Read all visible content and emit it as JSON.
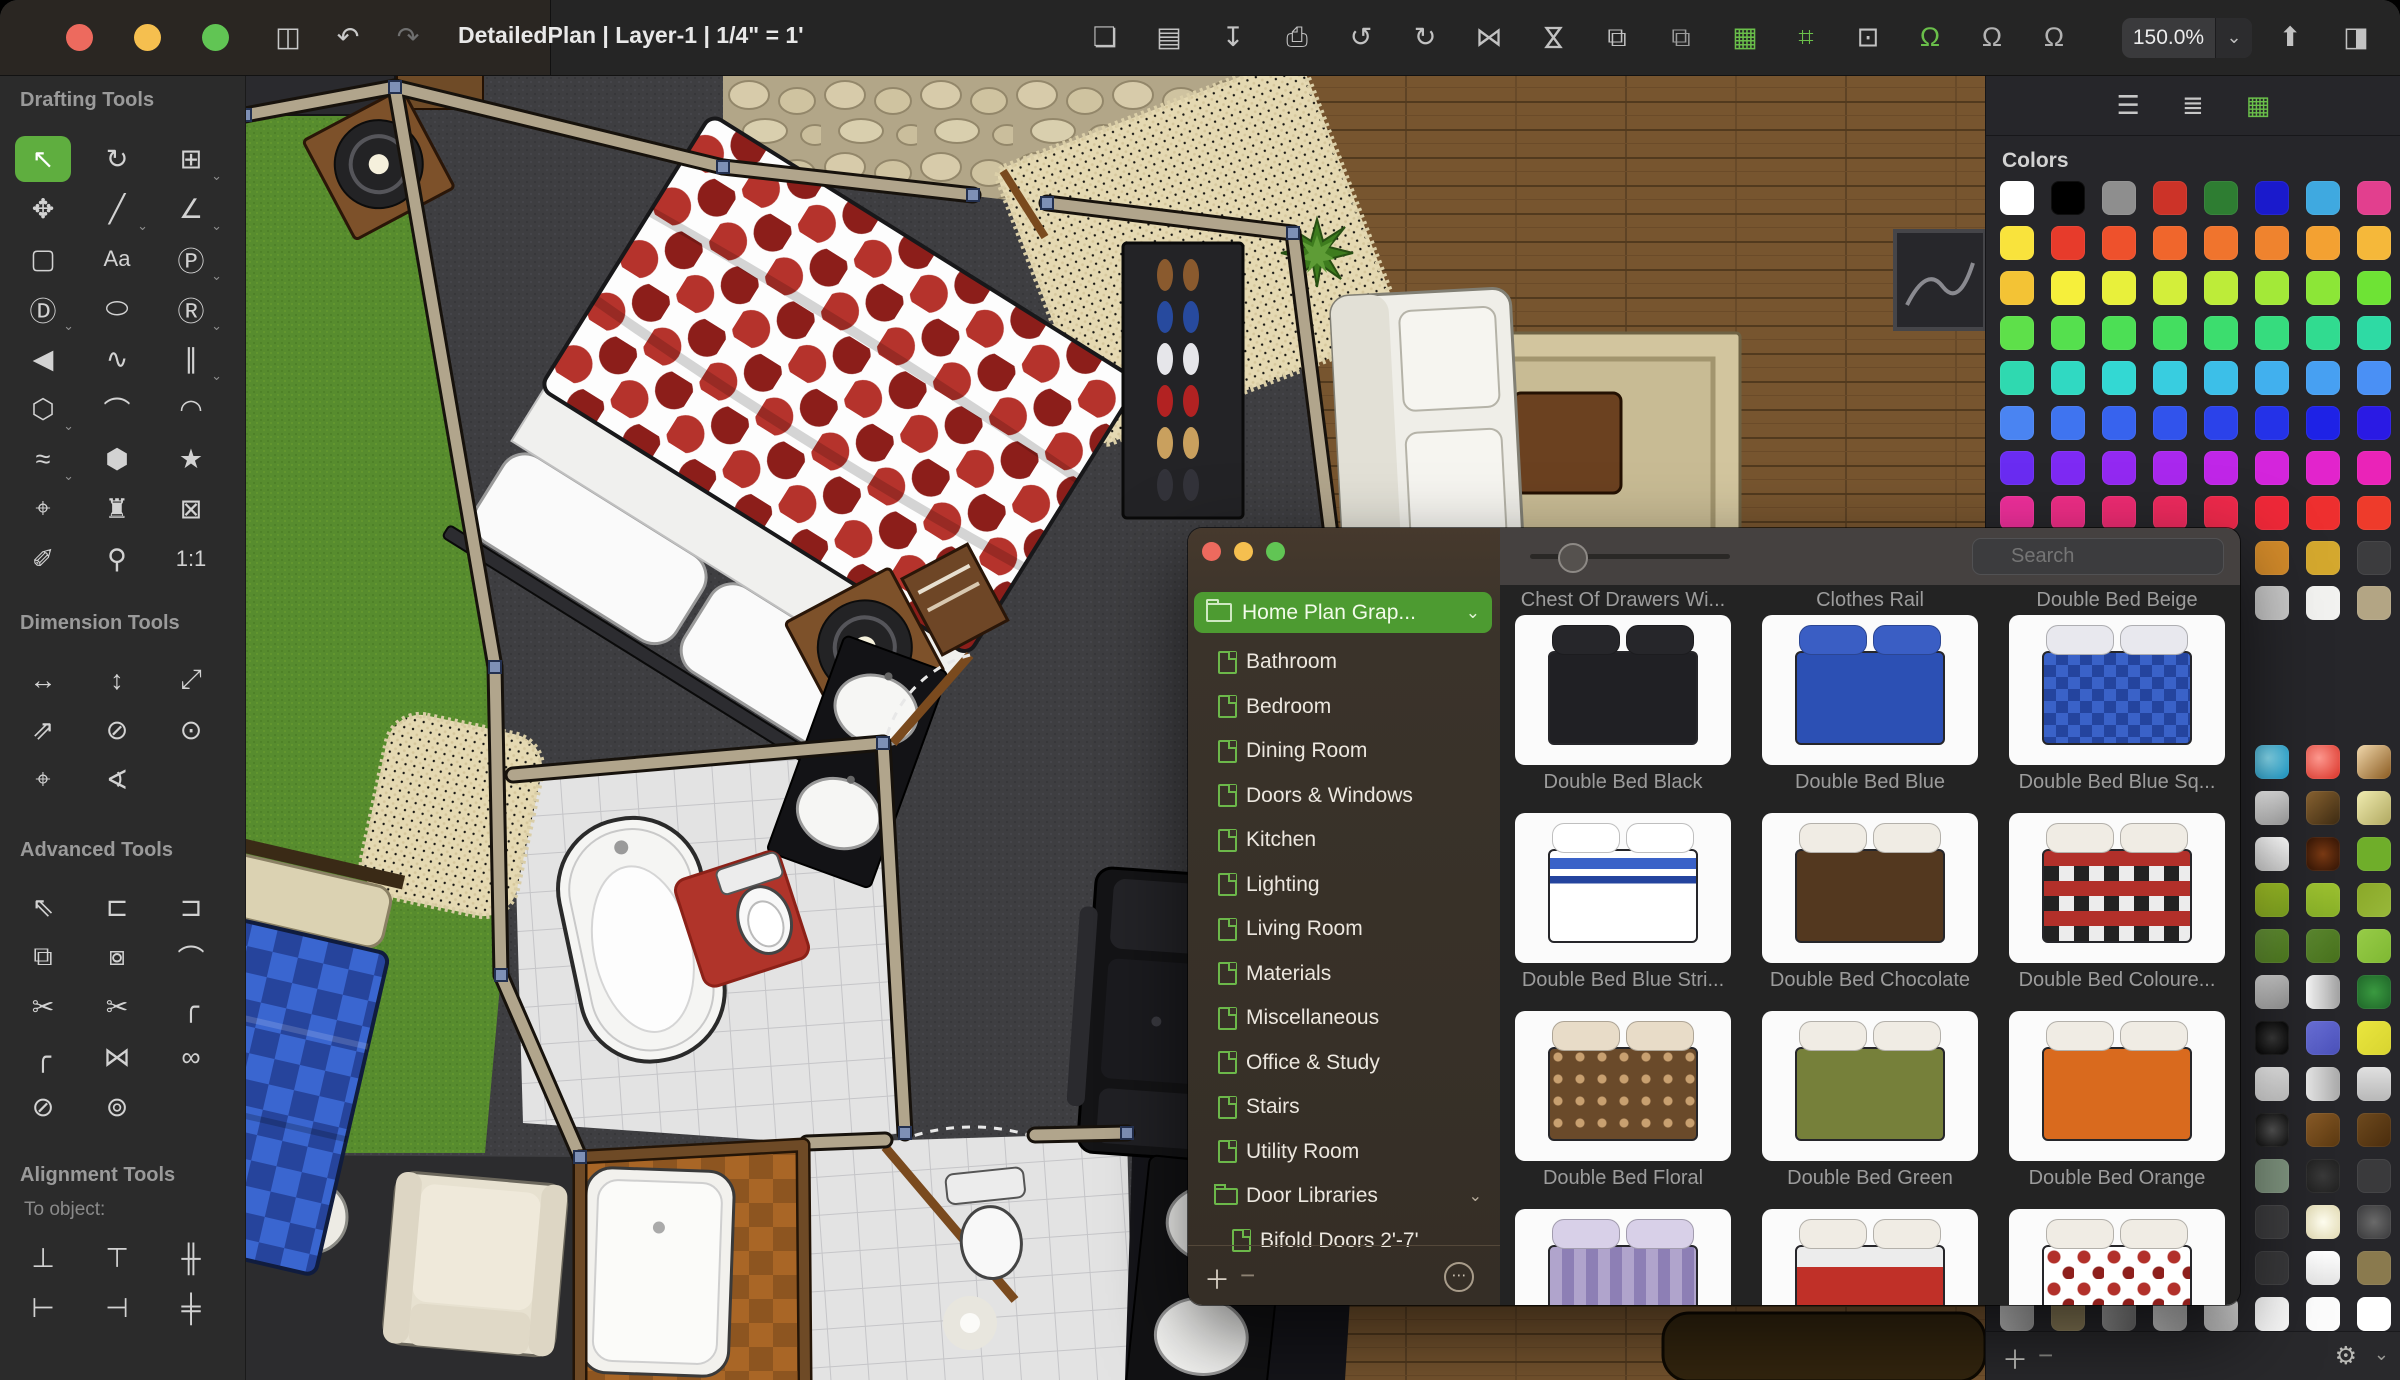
{
  "window": {
    "title": "DetailedPlan | Layer-1 | 1/4\" = 1'",
    "zoom_level": "150.0%",
    "traffic_lights": [
      "#ed6a5e",
      "#f5bf4f",
      "#61c554"
    ]
  },
  "toolbar": {
    "left_icons": [
      {
        "name": "sidebar-toggle",
        "glyph": "◫",
        "color": "#c8c8c8"
      },
      {
        "name": "undo",
        "glyph": "↶",
        "color": "#c8c8c8"
      },
      {
        "name": "redo",
        "glyph": "↷",
        "color": "#6f6f6f"
      }
    ],
    "main_icons": [
      {
        "name": "new-document",
        "glyph": "❏",
        "color": "#c2c2c2"
      },
      {
        "name": "open-folder",
        "glyph": "▤",
        "color": "#c2c2c2"
      },
      {
        "name": "import",
        "glyph": "↧",
        "color": "#c2c2c2"
      },
      {
        "name": "print",
        "glyph": "⎙",
        "color": "#c2c2c2"
      },
      {
        "name": "rotate-left",
        "glyph": "↺",
        "color": "#c2c2c2"
      },
      {
        "name": "rotate-right",
        "glyph": "↻",
        "color": "#c2c2c2"
      },
      {
        "name": "flip-horizontal",
        "glyph": "⋈",
        "color": "#c2c2c2"
      },
      {
        "name": "flip-vertical",
        "glyph": "⋈",
        "color": "#c2c2c2",
        "rot": true
      },
      {
        "name": "copy-style",
        "glyph": "⧉",
        "color": "#c2c2c2"
      },
      {
        "name": "duplicate",
        "glyph": "⧉",
        "color": "#9c9c9c"
      },
      {
        "name": "grid-view",
        "glyph": "▦",
        "color": "#6abf4a"
      }
    ],
    "snap_icons": [
      {
        "name": "snap-to-guides",
        "glyph": "⌗",
        "color": "#6abf4a"
      },
      {
        "name": "frame-tool",
        "glyph": "⊡",
        "color": "#c2c2c2"
      },
      {
        "name": "snap-to-object",
        "glyph": "Ω",
        "color": "#6abf4a"
      },
      {
        "name": "snap-to-grid",
        "glyph": "Ω",
        "color": "#b2b2b2"
      },
      {
        "name": "snap-to-edge",
        "glyph": "Ω",
        "color": "#b2b2b2"
      }
    ],
    "right_icons": [
      {
        "name": "share",
        "glyph": "⬆",
        "color": "#c2c2c2"
      },
      {
        "name": "right-panel-toggle",
        "glyph": "◨",
        "color": "#c2c2c2"
      }
    ],
    "zoom_chevron": "⌄"
  },
  "sidebar": {
    "sections": [
      {
        "title": "Drafting Tools",
        "tools": [
          {
            "name": "select-tool",
            "glyph": "↖",
            "active": true
          },
          {
            "name": "rotate-tool",
            "glyph": "↻"
          },
          {
            "name": "crop-tool",
            "glyph": "⊞",
            "menu": true
          },
          {
            "name": "pan-tool",
            "glyph": "✥"
          },
          {
            "name": "line-tool",
            "glyph": "╱",
            "menu": true
          },
          {
            "name": "angle-line-tool",
            "glyph": "∠",
            "menu": true
          },
          {
            "name": "rectangle-tool",
            "glyph": "▢"
          },
          {
            "name": "text-tool",
            "glyph": "Aa",
            "small": true
          },
          {
            "name": "parametric-shape-tool",
            "glyph": "Ⓟ",
            "menu": true
          },
          {
            "name": "dimension-shape-tool",
            "glyph": "Ⓓ",
            "menu": true
          },
          {
            "name": "ellipse-tool",
            "glyph": "⬭"
          },
          {
            "name": "rounded-rect-tool",
            "glyph": "Ⓡ",
            "menu": true
          },
          {
            "name": "arrow-shape-tool",
            "glyph": "◀"
          },
          {
            "name": "zigzag-tool",
            "glyph": "∿"
          },
          {
            "name": "parallel-line-tool",
            "glyph": "∥",
            "menu": true
          },
          {
            "name": "polygon-tool",
            "glyph": "⬡",
            "menu": true
          },
          {
            "name": "bezier-tool",
            "glyph": "⌒"
          },
          {
            "name": "arc-tool",
            "glyph": "◠"
          },
          {
            "name": "freehand-tool",
            "glyph": "≈",
            "menu": true
          },
          {
            "name": "blob-tool",
            "glyph": "⬢"
          },
          {
            "name": "star-tool",
            "glyph": "★"
          },
          {
            "name": "center-mark-tool",
            "glyph": "⌖"
          },
          {
            "name": "stamp-tool",
            "glyph": "♜"
          },
          {
            "name": "delete-box-tool",
            "glyph": "⊠"
          },
          {
            "name": "eyedropper-tool",
            "glyph": "✐"
          },
          {
            "name": "zoom-tool",
            "glyph": "⚲"
          },
          {
            "name": "actual-size-tool",
            "glyph": "1:1",
            "small": true
          }
        ]
      },
      {
        "title": "Dimension Tools",
        "tools": [
          {
            "name": "horizontal-dimension-tool",
            "glyph": "↔"
          },
          {
            "name": "vertical-dimension-tool",
            "glyph": "↕"
          },
          {
            "name": "diagonal-dimension-tool",
            "glyph": "⤢"
          },
          {
            "name": "angled-dimension-tool",
            "glyph": "⇗"
          },
          {
            "name": "diameter-dimension-tool",
            "glyph": "⊘"
          },
          {
            "name": "radius-dimension-tool",
            "glyph": "⊙"
          },
          {
            "name": "center-dimension-tool",
            "glyph": "⌖"
          },
          {
            "name": "angle-dimension-tool",
            "glyph": "∢"
          }
        ]
      },
      {
        "title": "Advanced Tools",
        "tools": [
          {
            "name": "advanced-select-tool",
            "glyph": "⇖"
          },
          {
            "name": "push-left-tool",
            "glyph": "⊏"
          },
          {
            "name": "push-right-tool",
            "glyph": "⊐"
          },
          {
            "name": "combine-shapes-tool",
            "glyph": "⧉"
          },
          {
            "name": "subtract-shapes-tool",
            "glyph": "⧇"
          },
          {
            "name": "edit-points-tool",
            "glyph": "⌒"
          },
          {
            "name": "cut-tool",
            "glyph": "✂"
          },
          {
            "name": "cut-multiple-tool",
            "glyph": "✂"
          },
          {
            "name": "fillet-corner-tool",
            "glyph": "╭"
          },
          {
            "name": "chamfer-corner-tool",
            "glyph": "╭"
          },
          {
            "name": "mirror-tool",
            "glyph": "⋈"
          },
          {
            "name": "link-objects-tool",
            "glyph": "∞"
          },
          {
            "name": "unlink-objects-tool",
            "glyph": "⊘"
          },
          {
            "name": "unlink-all-tool",
            "glyph": "⊚"
          }
        ]
      },
      {
        "title": "Alignment Tools",
        "subtitle": "To object:",
        "tools": [
          {
            "name": "align-bottom-tool",
            "glyph": "⊥"
          },
          {
            "name": "align-top-tool",
            "glyph": "⊤"
          },
          {
            "name": "distribute-vertical-tool",
            "glyph": "╫"
          },
          {
            "name": "align-left-tool",
            "glyph": "⊢"
          },
          {
            "name": "align-right-tool",
            "glyph": "⊣"
          },
          {
            "name": "distribute-horizontal-tool",
            "glyph": "╪"
          }
        ]
      }
    ]
  },
  "library": {
    "collection": "Home Plan Grap...",
    "collection_chevron": "⌄",
    "categories": [
      "Bathroom",
      "Bedroom",
      "Dining Room",
      "Doors & Windows",
      "Kitchen",
      "Lighting",
      "Living Room",
      "Materials",
      "Miscellaneous",
      "Office & Study",
      "Stairs",
      "Utility Room"
    ],
    "folder": "Door Libraries",
    "folder_chevron": "⌄",
    "folder_child": "Bifold Doors 2'-7'",
    "search_placeholder": "Search",
    "footer": {
      "add": "＋",
      "remove": "−",
      "more": "⋯"
    },
    "top_captions": [
      "Chest Of Drawers Wi...",
      "Clothes Rail",
      "Double Bed Beige"
    ],
    "rows": [
      [
        {
          "label": "Double Bed Black",
          "style": "black"
        },
        {
          "label": "Double Bed Blue",
          "style": "blue"
        },
        {
          "label": "Double Bed Blue Sq...",
          "style": "bluesq"
        }
      ],
      [
        {
          "label": "Double Bed Blue Stri...",
          "style": "bluestri"
        },
        {
          "label": "Double Bed Chocolate",
          "style": "chocolate"
        },
        {
          "label": "Double Bed Coloure...",
          "style": "coloured"
        }
      ],
      [
        {
          "label": "Double Bed Floral",
          "style": "floral"
        },
        {
          "label": "Double Bed Green",
          "style": "green"
        },
        {
          "label": "Double Bed Orange",
          "style": "orange"
        }
      ],
      [
        {
          "label": "",
          "style": "purple"
        },
        {
          "label": "",
          "style": "redwhite"
        },
        {
          "label": "",
          "style": "polka"
        }
      ]
    ]
  },
  "colors_panel": {
    "title": "Colors",
    "header_icons": [
      {
        "name": "adjust-sliders",
        "glyph": "☰",
        "color": "#c7c7c7"
      },
      {
        "name": "layers",
        "glyph": "≣",
        "color": "#c7c7c7"
      },
      {
        "name": "swatch-grid",
        "glyph": "▦",
        "color": "#6abf4a"
      }
    ],
    "solid_rows": [
      [
        "#ffffff",
        "#000000",
        "#8e8e8e",
        "#cc3328",
        "#2e7d32",
        "#1a1acc",
        "#3fa9e0",
        "#e23f8e"
      ],
      [
        "#f9e33c",
        "#e73b2b",
        "#ee512c",
        "#f0662c",
        "#f0742d",
        "#ef832e",
        "#f3a132",
        "#f5b83a"
      ],
      [
        "#f3c335",
        "#f6ef3b",
        "#e8f03b",
        "#d3ee3a",
        "#bdec39",
        "#a3e938",
        "#8ce637",
        "#6ee335"
      ],
      [
        "#5ee04a",
        "#55e04e",
        "#4cdf55",
        "#44de60",
        "#3cdd6e",
        "#36dc7e",
        "#31db90",
        "#2edaa4"
      ],
      [
        "#2fd9b0",
        "#30d9c2",
        "#33d8d3",
        "#38cde0",
        "#3cbfe8",
        "#41b0ee",
        "#47a0f2",
        "#4a90f5"
      ],
      [
        "#4a84f2",
        "#3f74f0",
        "#3763ee",
        "#3153ec",
        "#2b42ea",
        "#2432e8",
        "#1e22e6",
        "#2a1ae4"
      ],
      [
        "#6a2cf2",
        "#7e2af4",
        "#9329f2",
        "#a928ee",
        "#c026e8",
        "#d425dc",
        "#e224cc",
        "#ea23b8"
      ],
      [
        "#ee2f9a",
        "#ee2d86",
        "#ee2b72",
        "#ee2a5e",
        "#ee294b",
        "#ee2838",
        "#ee2f2f",
        "#ee3b2b"
      ],
      [
        "#8a6a25",
        "#a07828",
        "#b8862b",
        "#c8942d",
        "#d2a02f",
        "#d28a2a",
        "#d4a82e",
        "#3c3c3e"
      ],
      [
        "#6a6a6c",
        "#7c7c7e",
        "#8e8e90",
        "#a8a8aa",
        "#bcbcbe",
        "#c9c9c9",
        "#f2f2f0",
        "#b3a584"
      ]
    ],
    "material_rows": [
      [
        "#4a4a4c",
        "#54544e",
        "#5e5a50",
        "#68604e",
        "#72664c",
        "radial-gradient(circle at 38% 38%, #8ae0f5, #1898c8)",
        "radial-gradient(circle at 38% 38%, #ff9a90, #d93025)",
        "linear-gradient(135deg, #f0d8ac, #8a5a20)"
      ],
      [
        "#4c4c4e",
        "#565650",
        "#605c52",
        "#6a6250",
        "#74684e",
        "linear-gradient(135deg, #ffffff, #9a9a9a)",
        "linear-gradient(135deg, #8a6432, #3c2a12)",
        "linear-gradient(135deg, #f0ecb0, #b0a860)"
      ],
      [
        "#4e4e50",
        "#585852",
        "#625e54",
        "#6c6452",
        "#766a50",
        "linear-gradient(180deg, #ffffff, #d0d0d0)",
        "radial-gradient(circle, #7a3a14, #2e1204)",
        "#6fae2a"
      ],
      [
        "#505052",
        "#5a5a54",
        "#646056",
        "#6e6654",
        "#786c52",
        "linear-gradient(135deg, #a8c828, #7ba020)",
        "linear-gradient(180deg, #9cc030, #88b028)",
        "linear-gradient(135deg, #8aa828, #98b83a)"
      ],
      [
        "#525254",
        "#5c5c56",
        "#666258",
        "#706856",
        "#7a6e54",
        "linear-gradient(135deg, #68963a, #4e7a1e)",
        "linear-gradient(135deg, #5c8830, #47701c)",
        "linear-gradient(135deg, #97cc48, #7fb832)"
      ],
      [
        "#545456",
        "#5e5e58",
        "#68645a",
        "#726a58",
        "#7c7056",
        "linear-gradient(135deg, #e0e0e0, #909090)",
        "linear-gradient(90deg, #f8f8f8, #a0a0a0)",
        "radial-gradient(circle, #3a9a40, #1e6428)"
      ],
      [
        "#565658",
        "#60605a",
        "#6a665c",
        "#746c5a",
        "#7e7258",
        "radial-gradient(circle, #3a3a3a, #000000)",
        "linear-gradient(135deg, #6a70d8, #4a50b8)",
        "linear-gradient(135deg, #eae63e, #d8d430)"
      ],
      [
        "#58585a",
        "#62625c",
        "#6c685e",
        "#766e5c",
        "#80745a",
        "linear-gradient(135deg, #f8f8f8, #c0c0c0)",
        "linear-gradient(90deg, #e8e8e8, #a8a8a8)",
        "linear-gradient(180deg, #e0e0e0, #b8b8b8)"
      ],
      [
        "#5a5a5c",
        "#64645e",
        "#6e6a60",
        "#78705e",
        "#82765c",
        "radial-gradient(circle, #555555, #0a0a0a)",
        "linear-gradient(135deg, #8a5c28, #5a3810)",
        "linear-gradient(135deg, #6e4a1e, #4a2c0c)"
      ],
      [
        "#5c5c5e",
        "#666660",
        "#706c62",
        "#7a7260",
        "#84785e",
        "#7e937e",
        "radial-gradient(circle, #3a3a3a, #1e1e1e)",
        "#3a3a3c"
      ],
      [
        "#5e5e60",
        "#686862",
        "#726e64",
        "#7c7462",
        "#867a60",
        "#3c3c3e",
        "radial-gradient(circle, #fffef0, #e0d8b0)",
        "radial-gradient(circle, #6a6a6a, #38383a)"
      ],
      [
        "#606062",
        "#6a6a64",
        "#747066",
        "#7e7664",
        "#887c62",
        "#38383a",
        "linear-gradient(180deg, #ffffff, #e4e4e4)",
        "#8a7a4e"
      ],
      [
        "linear-gradient(135deg, #e8e8e8, #9a9a9a)",
        "#8a7c58",
        "linear-gradient(135deg, #b8b8b8, #6a6a6a)",
        "linear-gradient(135deg, #e8e8e8, #aaaaaa)",
        "linear-gradient(180deg, #f0f0f0, #c8c8c8)",
        "#fafafa",
        "#fcfcfc",
        "#ffffff"
      ]
    ],
    "footer": {
      "add": "＋",
      "remove": "−",
      "gear": "⚙",
      "chevron": "⌄"
    }
  }
}
